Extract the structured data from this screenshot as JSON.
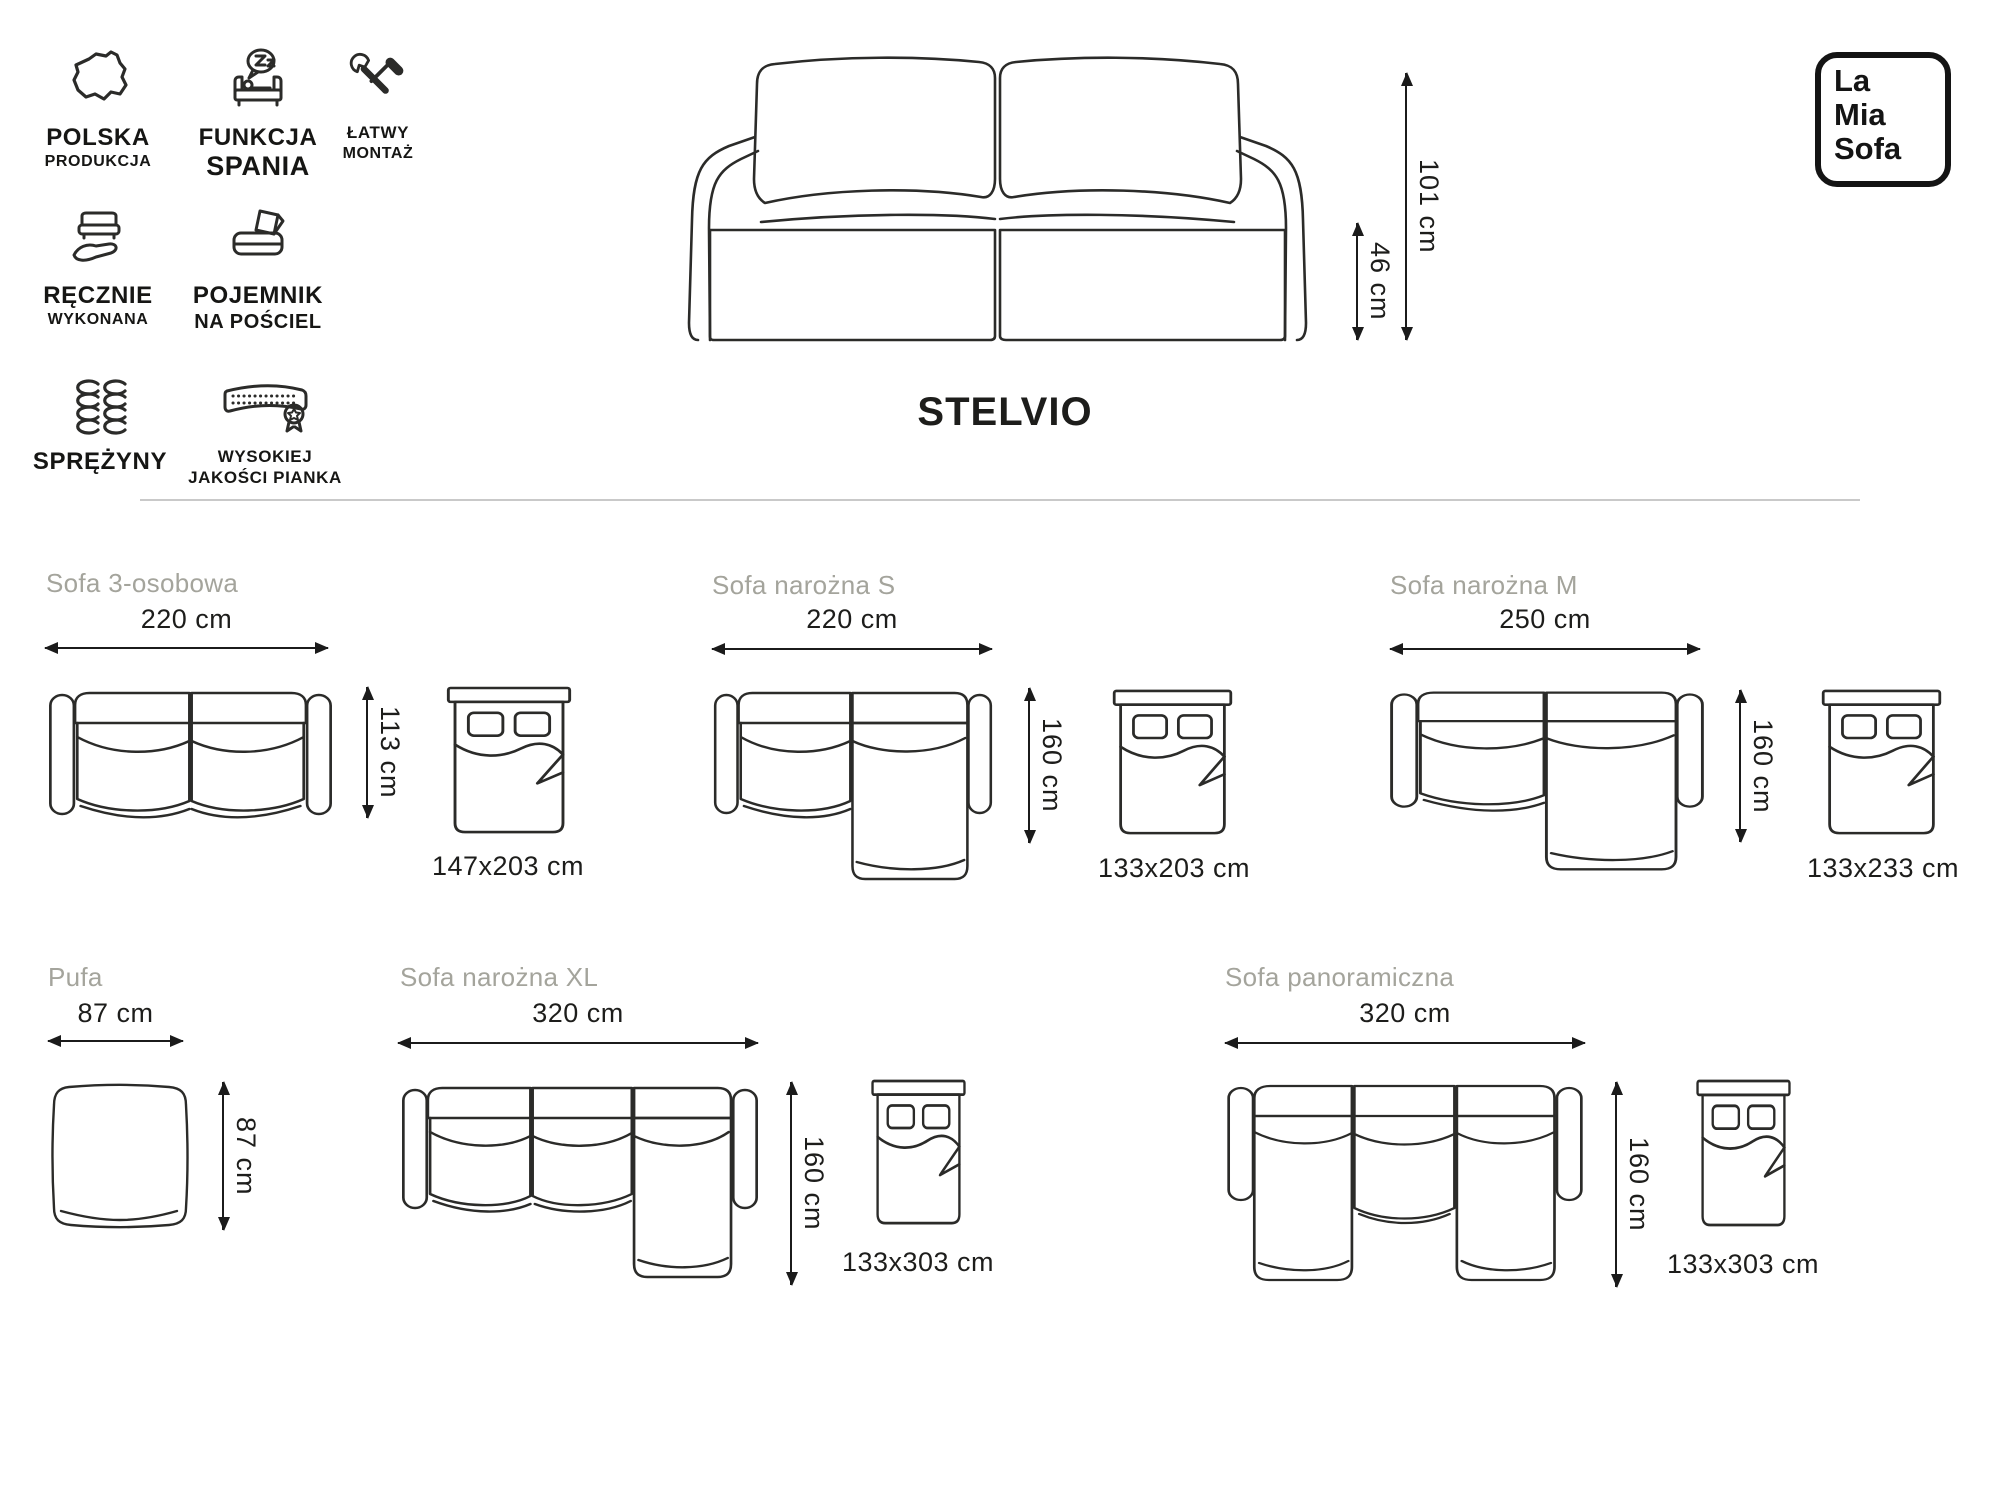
{
  "brand": {
    "line1": "La",
    "line2": "Mia",
    "line3": "Sofa"
  },
  "product": {
    "name": "STELVIO",
    "height": "101 cm",
    "seat_height": "46 cm"
  },
  "features": [
    {
      "icon": "poland-map-icon",
      "label1": "POLSKA",
      "label2": "PRODUKCJA"
    },
    {
      "icon": "sleep-function-icon",
      "label1": "FUNKCJA",
      "label2": "SPANIA"
    },
    {
      "icon": "easy-assembly-icon",
      "label1": "ŁATWY",
      "label2": "MONTAŻ"
    },
    {
      "icon": "handmade-icon",
      "label1": "RĘCZNIE",
      "label2": "WYKONANA"
    },
    {
      "icon": "bedding-storage-icon",
      "label1": "POJEMNIK",
      "label2": "NA POŚCIEL"
    },
    {
      "icon": "springs-icon",
      "label1": "SPRĘŻYNY",
      "label2": ""
    },
    {
      "icon": "foam-icon",
      "label1": "WYSOKIEJ",
      "label2": "JAKOŚCI PIANKA"
    }
  ],
  "variants": [
    {
      "name": "Sofa 3-osobowa",
      "width": "220 cm",
      "depth": "113 cm",
      "bed": "147x203 cm"
    },
    {
      "name": "Sofa narożna S",
      "width": "220 cm",
      "depth": "160 cm",
      "bed": "133x203 cm"
    },
    {
      "name": "Sofa narożna M",
      "width": "250 cm",
      "depth": "160 cm",
      "bed": "133x233 cm"
    },
    {
      "name": "Pufa",
      "width": "87 cm",
      "depth": "87 cm"
    },
    {
      "name": "Sofa narożna XL",
      "width": "320 cm",
      "depth": "160 cm",
      "bed": "133x303 cm"
    },
    {
      "name": "Sofa panoramiczna",
      "width": "320 cm",
      "depth": "160 cm",
      "bed": "133x303 cm"
    }
  ]
}
